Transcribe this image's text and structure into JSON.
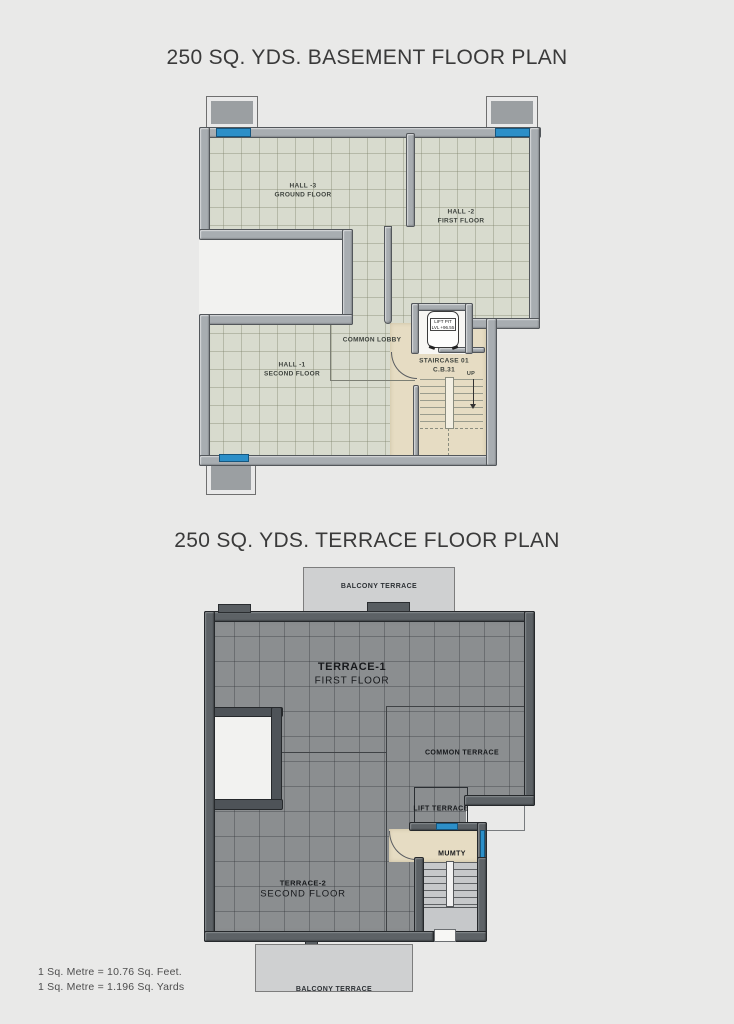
{
  "basement": {
    "title": "250 SQ. YDS. BASEMENT FLOOR PLAN",
    "labels": {
      "hall3_name": "HALL -3",
      "hall3_floor": "GROUND FLOOR",
      "hall2_name": "HALL -2",
      "hall2_floor": "FIRST FLOOR",
      "hall1_name": "HALL -1",
      "hall1_floor": "SECOND FLOOR",
      "lobby": "COMMON LOBBY",
      "staircase_name": "STAIRCASE 01",
      "staircase_code": "C.B.31",
      "up": "UP",
      "lift_name": "LIFT PIT",
      "lift_level": "LVL +96.55"
    }
  },
  "terrace": {
    "title": "250 SQ. YDS. TERRACE FLOOR PLAN",
    "labels": {
      "balcony_top": "BALCONY TERRACE",
      "terrace1_name": "TERRACE-1",
      "terrace1_floor": "FIRST FLOOR",
      "common": "COMMON TERRACE",
      "lift_terrace": "LIFT TERRACE",
      "mumty": "MUMTY",
      "terrace2_name": "TERRACE-2",
      "terrace2_floor": "SECOND FLOOR",
      "balcony_bottom": "BALCONY TERRACE"
    }
  },
  "footer": {
    "line1": "1 Sq. Metre = 10.76 Sq. Feet.",
    "line2": "1 Sq. Metre = 1.196 Sq. Yards"
  },
  "colors": {
    "background": "#e9e9e8",
    "basement_floor": "#d8dbce",
    "terrace_floor": "#8b8e90",
    "wall_light": "#a8adb1",
    "wall_dark": "#5d6266",
    "window_blue": "#2c8fc8",
    "staircase_beige": "#e6dcc3"
  }
}
